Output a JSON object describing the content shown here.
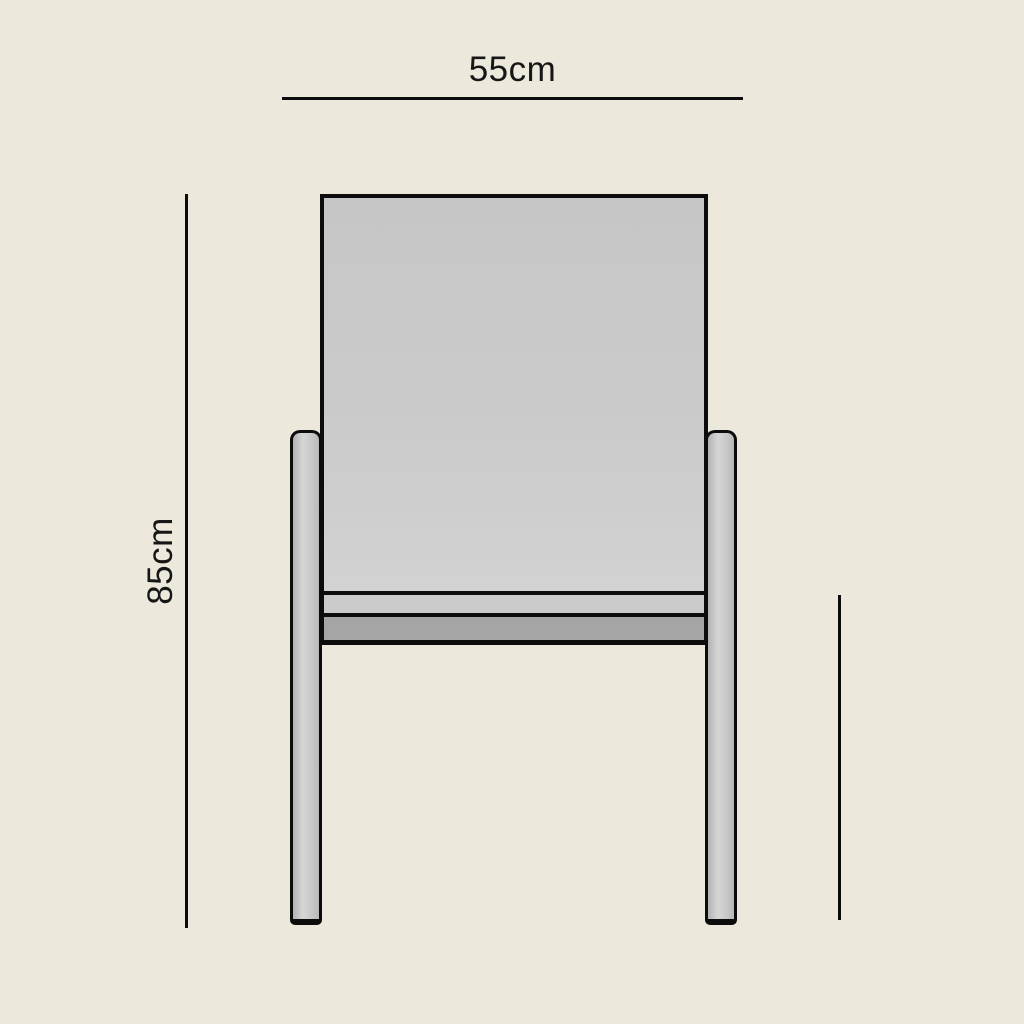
{
  "diagram": {
    "kind": "furniture-dimension-drawing",
    "subject": "chair-front-view",
    "width_dimension": {
      "label": "55cm"
    },
    "height_dimension": {
      "label": "85cm"
    },
    "colors": {
      "background": "#ECE9DC",
      "outline": "#0C0C0C",
      "label_text": "#161616",
      "backrest_fill": "#C9C9C9",
      "seat_edge_fill": "#CBCBCB",
      "seat_apron_fill": "#A5A5A5",
      "leg_fill": "#C6C6C6"
    }
  }
}
